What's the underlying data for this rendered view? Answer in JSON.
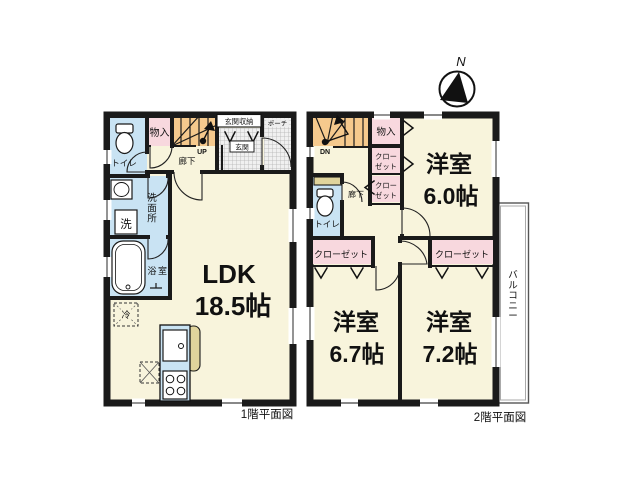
{
  "compass": {
    "north_label": "N"
  },
  "colors": {
    "wall": "#1a1a1a",
    "room": "#f8f4dc",
    "wet": "#c9e3f3",
    "closet": "#f8d8de",
    "stairs": "#f5c98d",
    "counter": "#e0d49c",
    "tile": "#efefef"
  },
  "floor1": {
    "caption": "1階平面図",
    "ldk_name": "LDK",
    "ldk_size": "18.5帖",
    "toilet": "トイレ",
    "washroom": "洗面所",
    "bath": "浴室",
    "laundry": "洗",
    "fridge": "冷",
    "storage": "物入",
    "hallway": "廊下",
    "stairs_label": "UP",
    "entrance_storage": "玄関収納",
    "entrance": "玄関",
    "porch": "ポーチ"
  },
  "floor2": {
    "caption": "2階平面図",
    "room_a_name": "洋室",
    "room_a_size": "6.0帖",
    "room_b_name": "洋室",
    "room_b_size": "6.7帖",
    "room_c_name": "洋室",
    "room_c_size": "7.2帖",
    "storage": "物入",
    "closet_line1": "クロー",
    "closet_line2": "ゼット",
    "closet_wide": "クローゼット",
    "toilet": "トイレ",
    "hallway": "廊下",
    "stairs_label": "DN",
    "balcony": "バルコニー"
  }
}
